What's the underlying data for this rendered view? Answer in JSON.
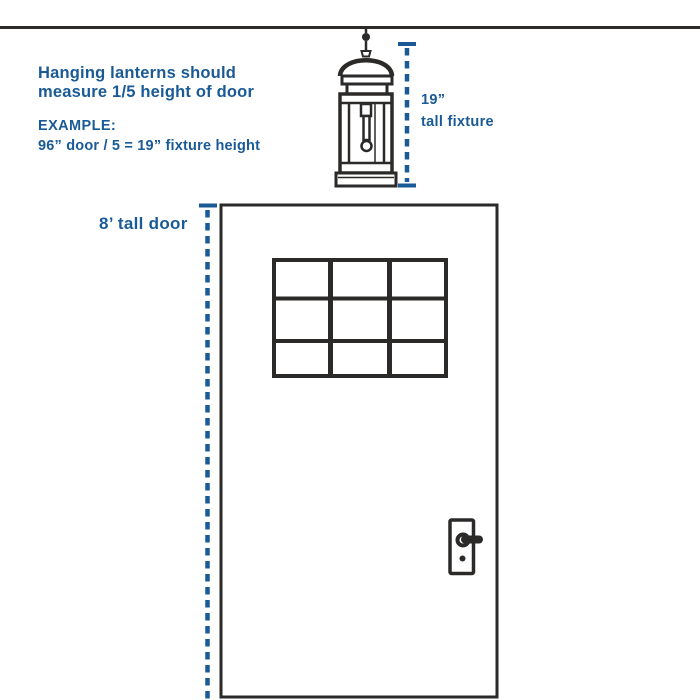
{
  "colors": {
    "accent_blue": "#1a5a96",
    "line_ink": "#2b2a29"
  },
  "instruction": {
    "headline": "Hanging lanterns should\nmeasure 1/5 height of door",
    "example_label": "EXAMPLE:",
    "example_formula": "96” door / 5 = 19” fixture height"
  },
  "annotations": {
    "fixture_height": "19”\ntall fixture",
    "door_height": "8’ tall door"
  },
  "illustrations": {
    "lantern": "hanging-lantern-line-drawing",
    "door": "front-door-with-nine-pane-window",
    "handle": "door-lever-handle"
  }
}
